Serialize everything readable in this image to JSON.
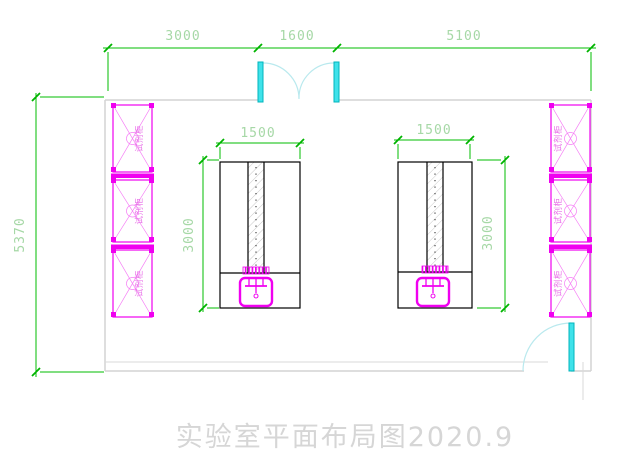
{
  "drawing": {
    "title": "实验室平面布局图2020.9",
    "room_dimensions": {
      "top": [
        {
          "label": "3000"
        },
        {
          "label": "1600"
        },
        {
          "label": "5100"
        }
      ],
      "left": {
        "label": "5370"
      }
    },
    "benches": [
      {
        "width_label": "1500",
        "depth_label": "3000"
      },
      {
        "width_label": "1500",
        "depth_label": "3000"
      }
    ],
    "cabinet_label": "试剂柜",
    "colors": {
      "dimension_line": "#00bc00",
      "dimension_text": "#a6d8a6",
      "cabinet": "#f000f0",
      "door": "#3fe2ea",
      "door_arc": "#b9e9ee",
      "wall": "#d4d4d4",
      "bench_outline": "#000000",
      "title_text": "#d6d6d6"
    }
  }
}
